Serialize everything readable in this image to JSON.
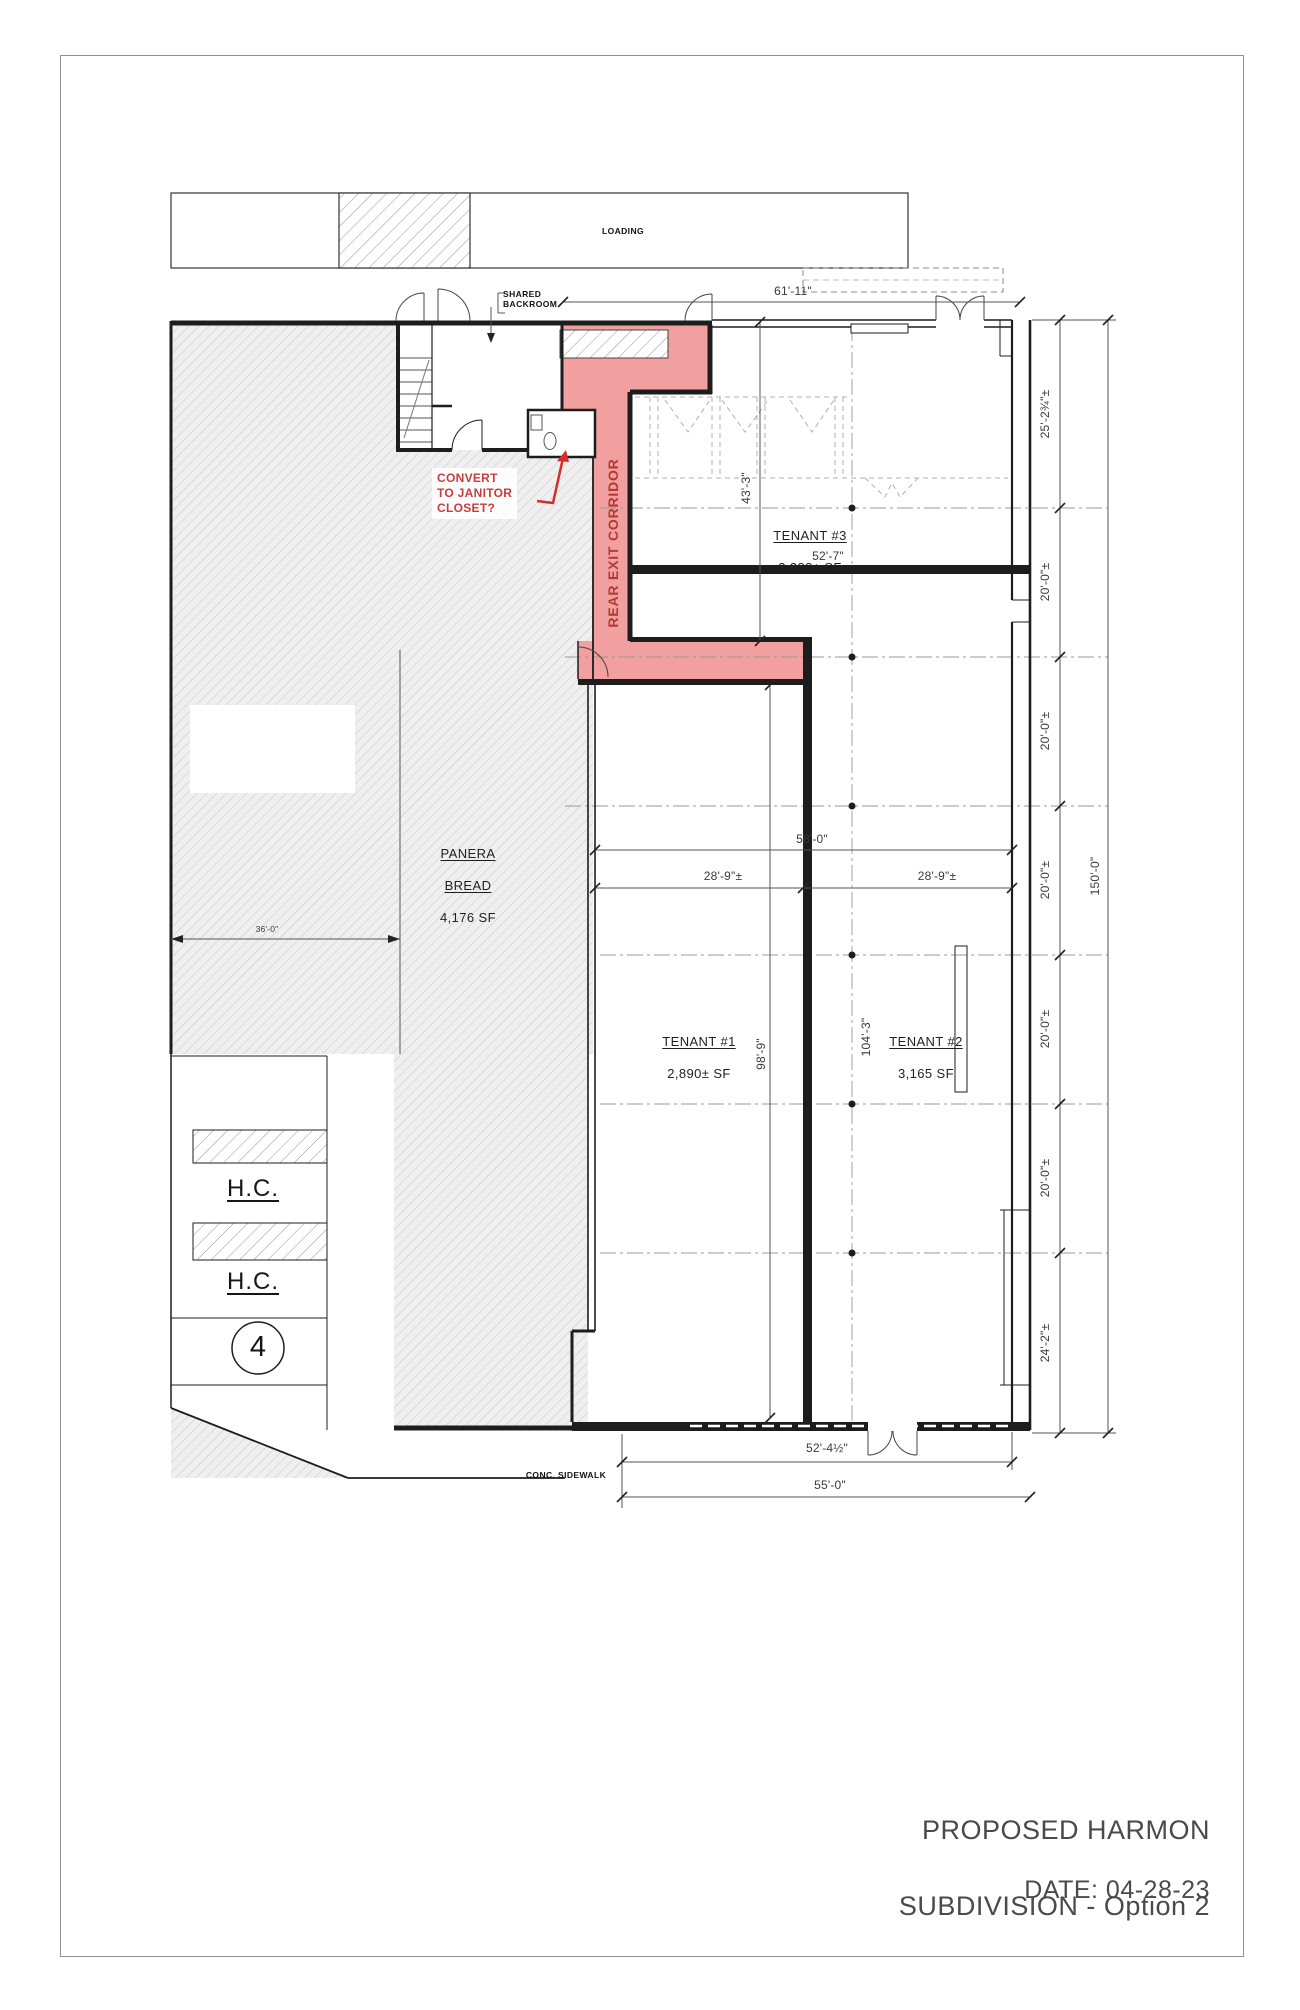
{
  "sheet": {
    "title_line1": "PROPOSED HARMON",
    "title_line2": "SUBDIVISION - Option 2",
    "date": "DATE: 04-28-23"
  },
  "annotations": {
    "loading": "LOADING",
    "shared_backroom": "SHARED\nBACKROOM",
    "convert_note": "CONVERT\nTO JANITOR\nCLOSET?",
    "rear_exit_corridor": "REAR EXIT CORRIDOR",
    "conc_sidewalk": "CONC. SIDEWALK",
    "hc_stall_upper": "H.C.",
    "hc_stall_lower": "H.C.",
    "parking_count": "4"
  },
  "tenants": {
    "panera": {
      "name_line1": "PANERA",
      "name_line2": "BREAD",
      "area": "4,176 SF"
    },
    "tenant1": {
      "name": "TENANT #1",
      "area": "2,890± SF"
    },
    "tenant2": {
      "name": "TENANT #2",
      "area": "3,165 SF"
    },
    "tenant3": {
      "name": "TENANT #3",
      "area": "2,288± SF"
    }
  },
  "dimensions": {
    "top_overall": "61'-11\"",
    "tenant3_width": "52'-7\"",
    "tenant3_depth": "43'-3\"",
    "rear_width": "58'-0\"",
    "tenant1_width": "28'-9\"±",
    "tenant2_width": "28'-9\"±",
    "panera_width": "36'-0\"",
    "tenant1_depth": "98'-9\"",
    "tenant2_depth": "104'-3\"",
    "right_total": "150'-0\"",
    "right_chain": [
      "25'-2¾\"±",
      "20'-0\"±",
      "20'-0\"±",
      "20'-0\"±",
      "20'-0\"±",
      "20'-0\"±",
      "24'-2\"±"
    ],
    "storefront_width": "52'-4½\"",
    "sidewalk_width": "55'-0\""
  },
  "colors": {
    "corridor_highlight": "#f19f9f",
    "annotation_red": "#cc3b3b",
    "corridor_text_red": "#b23a35",
    "wall": "#1d1d1d"
  }
}
